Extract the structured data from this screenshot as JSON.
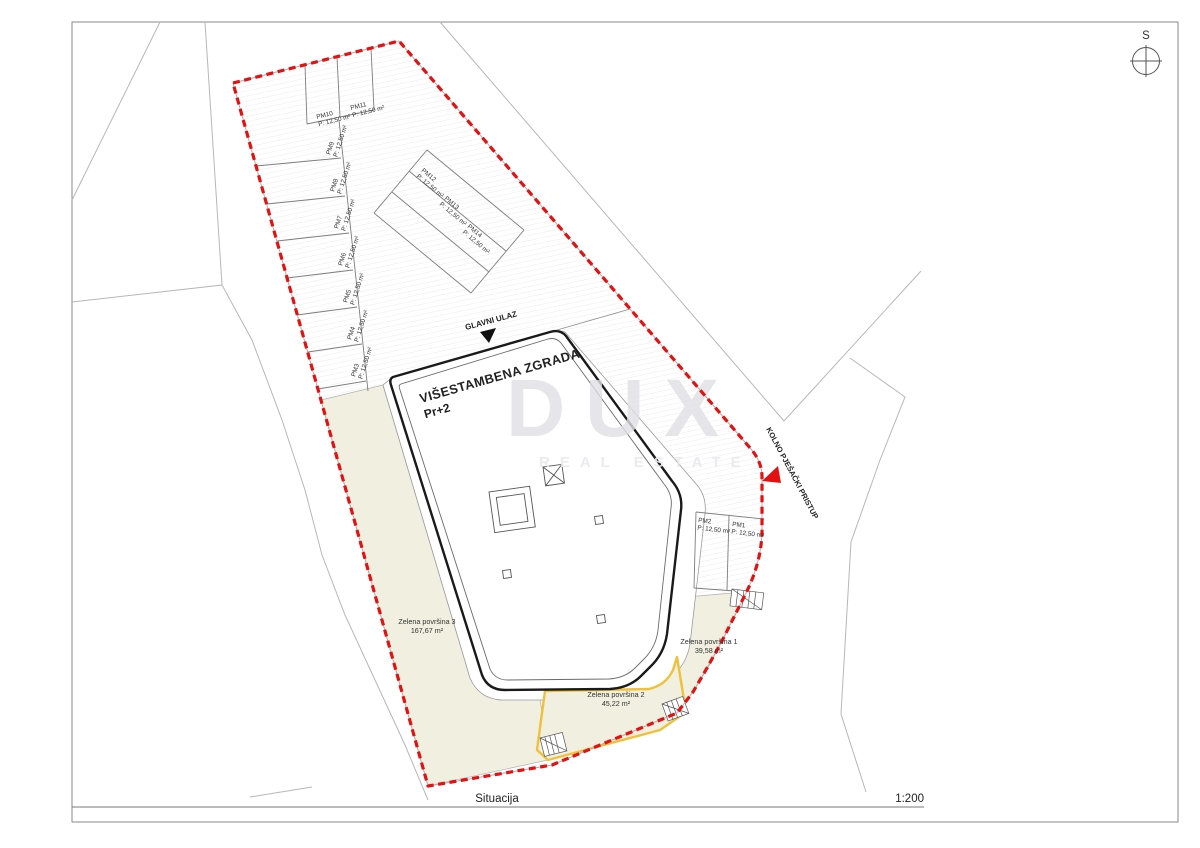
{
  "page": {
    "title": "Situacija",
    "scale": "1:200",
    "north_label": "S"
  },
  "watermark": {
    "brand": "DUX",
    "subtitle": "REAL ESTATE"
  },
  "site": {
    "building": {
      "name": "VIŠESTAMBENA ZGRADA",
      "floors": "Pr+2"
    },
    "main_entrance": "GLAVNI ULAZ",
    "access_road": "KOLNO PJEŠAČKI PRISTUP",
    "green_areas": [
      {
        "name": "Zelena površina 1",
        "area": "39,58 m²"
      },
      {
        "name": "Zelena površina 2",
        "area": "45,22 m²"
      },
      {
        "name": "Zelena površina 3",
        "area": "167,67 m²"
      }
    ],
    "parking": {
      "stall_area": "P: 12,50 m²",
      "stalls": [
        "PM1",
        "PM2",
        "PM3",
        "PM4",
        "PM5",
        "PM6",
        "PM7",
        "PM8",
        "PM9",
        "PM10",
        "PM11",
        "PM12",
        "PM13",
        "PM14"
      ]
    }
  },
  "colors": {
    "boundary_red": "#e31212",
    "green_outline_yellow": "#efc13b",
    "green_fill_beige": "#f1efdf",
    "building_outline": "#1a1a1a"
  }
}
